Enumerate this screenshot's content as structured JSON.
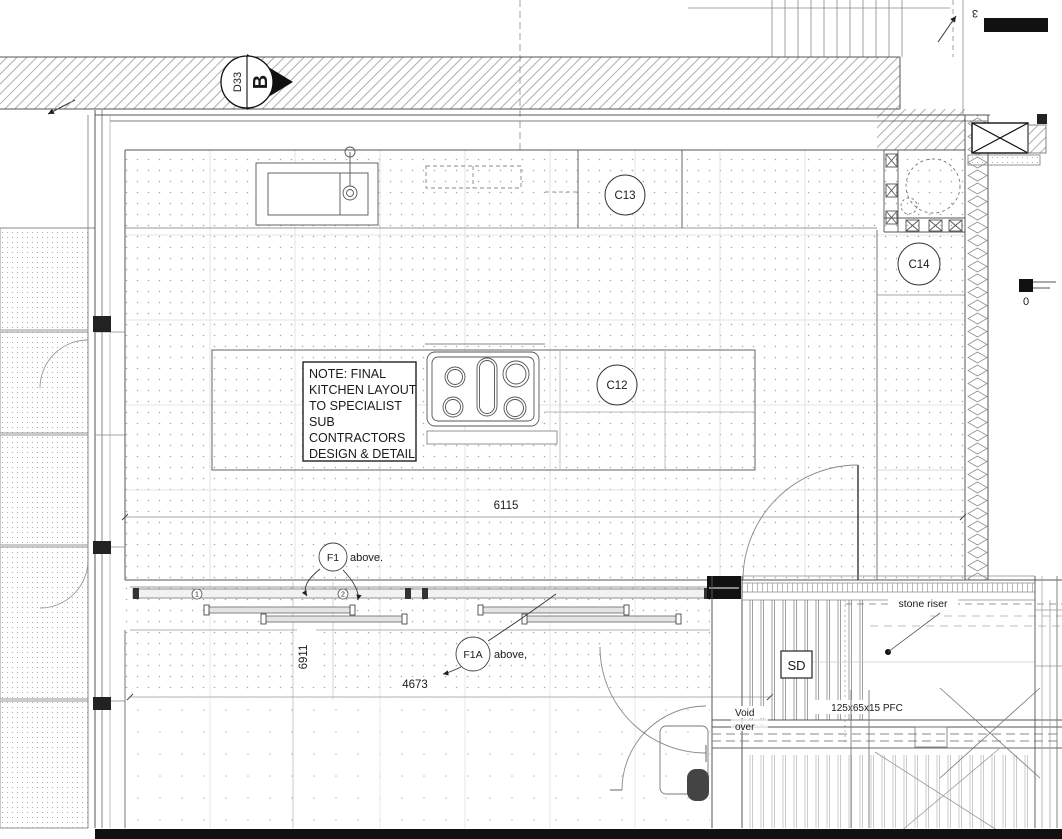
{
  "drawing": {
    "section_marker": {
      "ref": "D33",
      "letter": "B"
    },
    "grid": {
      "top_label": "3",
      "scale_zero": "0"
    },
    "callouts": {
      "c13": "C13",
      "c14": "C14",
      "c12": "C12"
    },
    "note_lines": [
      "NOTE: FINAL",
      "KITCHEN LAYOUT",
      "TO SPECIALIST",
      "SUB",
      "CONTRACTORS",
      "DESIGN & DETAIL"
    ],
    "dimensions": {
      "kitchen_width": "6115",
      "room_depth": "6911",
      "opening_width": "4673"
    },
    "floor_labels": {
      "f1_tag": "F1",
      "f1_text": "above.",
      "f1a_tag": "F1A",
      "f1a_text": "above,"
    },
    "track_markers": {
      "m1": "1",
      "m2": "2"
    },
    "terrace": {
      "sd": "SD",
      "stone_riser": "stone riser",
      "void_line1": "Void",
      "void_line2": "over",
      "beam_size": "125x65x15 PFC"
    },
    "colors": {
      "ink": "#1a1a1a",
      "paper": "#ffffff"
    }
  }
}
